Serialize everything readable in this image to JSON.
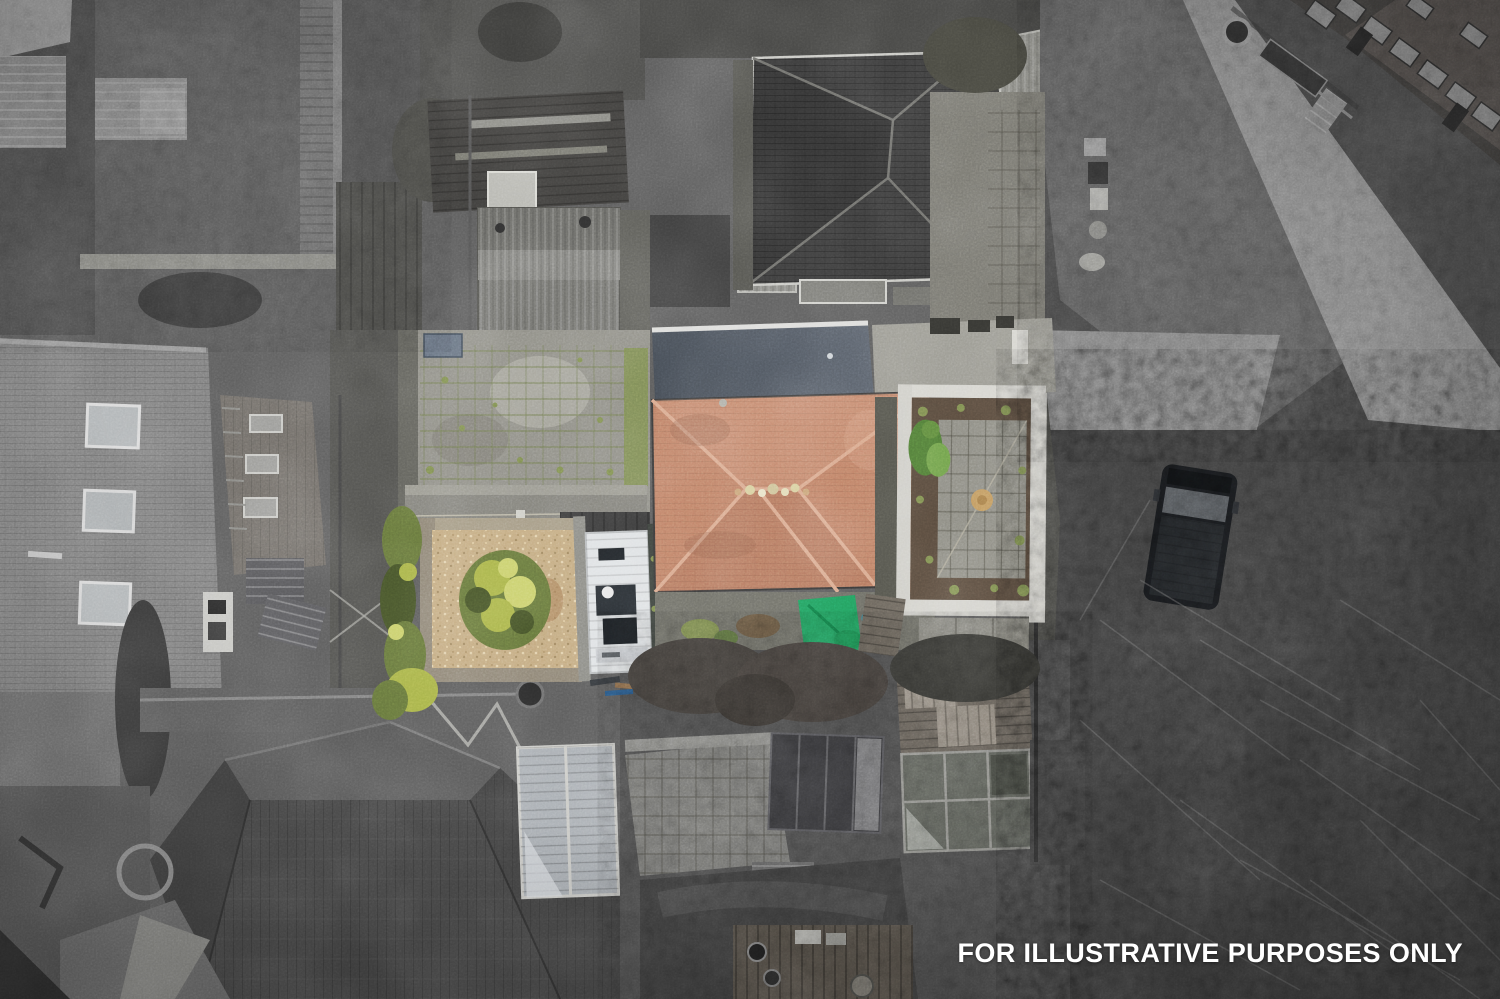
{
  "watermark": {
    "text": "FOR ILLUSTRATIVE PURPOSES ONLY"
  },
  "palette": {
    "base_ground": "#5c5c5c",
    "scrub_dark": "#434343",
    "lane_grey": "#929292",
    "roof_terracotta": "#c08267",
    "roof_terracotta_dark": "#96604d",
    "roof_terracotta_light": "#d9a98c",
    "flat_roof_dark": "#454c55",
    "flat_roof_light": "#5d646e",
    "slate_roof": "#3b3b3b",
    "left_roof_grey": "#7e7e7e",
    "concrete_slab": "#8f8e86",
    "concrete_light": "#a8a79d",
    "gravel": "#c3aa80",
    "gravel_light": "#dcc9a0",
    "hedge_green": "#66763c",
    "hedge_green_dark": "#46532a",
    "bush_yellow_green": "#a8b349",
    "bush_light": "#c9cf6b",
    "weed_green": "#7d8d4f",
    "tarp_green": "#23a05f",
    "garden_wall_white": "#d6d5cf",
    "soil_brown": "#57493c",
    "caravan_white": "#dfe2e4",
    "van_black": "#17191c",
    "ornament_tan": "#c1995f",
    "watermark_white": "#ffffff"
  }
}
